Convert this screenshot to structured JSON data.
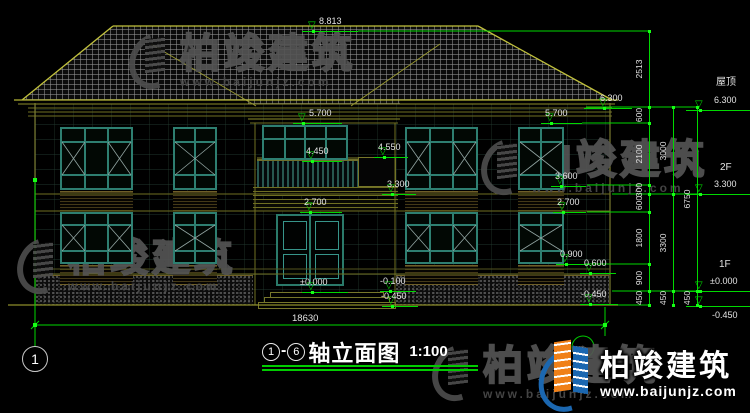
{
  "title": {
    "axis_from": "1",
    "dash": "-",
    "axis_to": "6",
    "text": "轴立面图",
    "scale": "1:100"
  },
  "axis": {
    "left_bubble": "1"
  },
  "dims": {
    "total_width": "18630"
  },
  "watermark": {
    "brand": "柏竣建筑",
    "url": "www.baijunjz.com"
  },
  "logo": {
    "brand": "柏竣建筑",
    "url": "www.baijunjz.com"
  },
  "colors": {
    "dim_green": "#00d800",
    "line_yellow": "#b5b535",
    "window_teal": "#2e7f71",
    "logo_blue": "#1b67b0",
    "logo_orange": "#f08018"
  },
  "level_markers": [
    {
      "v": "8.813",
      "y": 31,
      "x1": 302,
      "x2": 358,
      "tri": 313,
      "lx": 319,
      "ly": 16
    },
    {
      "v": "6.300",
      "y": 108,
      "x1": 584,
      "x2": 632,
      "tri": 604,
      "lx": 600,
      "ly": 93
    },
    {
      "v": "5.700",
      "y": 123,
      "x1": 293,
      "x2": 342,
      "tri": 303,
      "lx": 309,
      "ly": 108
    },
    {
      "v": "5.700",
      "y": 123,
      "x1": 541,
      "x2": 582,
      "tri": 551,
      "lx": 545,
      "ly": 108
    },
    {
      "v": "4.550",
      "y": 157,
      "x1": 374,
      "x2": 408,
      "tri": 384,
      "lx": 378,
      "ly": 142
    },
    {
      "v": "4.450",
      "y": 161,
      "x1": 302,
      "x2": 342,
      "tri": 312,
      "lx": 306,
      "ly": 146
    },
    {
      "v": "3.300",
      "y": 194,
      "x1": 382,
      "x2": 416,
      "tri": 392,
      "lx": 387,
      "ly": 179
    },
    {
      "v": "3.600",
      "y": 186,
      "x1": 551,
      "x2": 586,
      "tri": 561,
      "lx": 555,
      "ly": 171
    },
    {
      "v": "2.700",
      "y": 212,
      "x1": 300,
      "x2": 342,
      "tri": 310,
      "lx": 304,
      "ly": 197
    },
    {
      "v": "2.700",
      "y": 212,
      "x1": 553,
      "x2": 586,
      "tri": 563,
      "lx": 557,
      "ly": 197
    },
    {
      "v": "0.900",
      "y": 264,
      "x1": 556,
      "x2": 590,
      "tri": 566,
      "lx": 560,
      "ly": 249
    },
    {
      "v": "0.600",
      "y": 273,
      "x1": 580,
      "x2": 616,
      "tri": 590,
      "lx": 584,
      "ly": 258
    },
    {
      "v": "-0.450",
      "y": 304,
      "x1": 580,
      "x2": 618,
      "tri": 590,
      "lx": 581,
      "ly": 289
    },
    {
      "v": "±0.000",
      "y": 292,
      "x1": 302,
      "x2": 348,
      "tri": 312,
      "lx": 300,
      "ly": 277
    },
    {
      "v": "-0.100",
      "y": 291,
      "x1": 380,
      "x2": 416,
      "tri": 390,
      "lx": 380,
      "ly": 276
    },
    {
      "v": "-0.450",
      "y": 306,
      "x1": 382,
      "x2": 418,
      "tri": 392,
      "lx": 381,
      "ly": 291
    },
    {
      "v": "6.300",
      "name": "屋顶",
      "y": 110,
      "x1": 686,
      "x2": 750,
      "tri": 700,
      "lx": 714,
      "ly": 95,
      "nx": 716,
      "ny": 78
    },
    {
      "v": "3.300",
      "name": "2F",
      "y": 194,
      "x1": 686,
      "x2": 750,
      "tri": 700,
      "lx": 714,
      "ly": 179,
      "nx": 720,
      "ny": 163
    },
    {
      "v": "±0.000",
      "name": "1F",
      "y": 291,
      "x1": 686,
      "x2": 750,
      "tri": 700,
      "lx": 710,
      "ly": 276,
      "nx": 719,
      "ny": 260
    },
    {
      "v": "-0.450",
      "y": 306,
      "x1": 686,
      "x2": 750,
      "tri": 700,
      "lx": 712,
      "ly": 310,
      "below": true
    }
  ],
  "dim_chains": [
    {
      "x": 649,
      "segs": [
        {
          "v": "2513",
          "y1": 31,
          "y2": 107
        },
        {
          "v": "600",
          "y1": 107,
          "y2": 123
        },
        {
          "v": "2100",
          "y1": 123,
          "y2": 185
        },
        {
          "v": "300",
          "y1": 185,
          "y2": 194
        },
        {
          "v": "600",
          "y1": 194,
          "y2": 212
        },
        {
          "v": "1800",
          "y1": 212,
          "y2": 264
        },
        {
          "v": "900",
          "y1": 264,
          "y2": 291
        },
        {
          "v": "450",
          "y1": 291,
          "y2": 305
        }
      ]
    },
    {
      "x": 673,
      "segs": [
        {
          "v": "3000",
          "y1": 107,
          "y2": 194
        },
        {
          "v": "3300",
          "y1": 194,
          "y2": 291
        },
        {
          "v": "450",
          "y1": 291,
          "y2": 305
        }
      ]
    },
    {
      "x": 697,
      "segs": [
        {
          "v": "6750",
          "y1": 107,
          "y2": 291
        },
        {
          "v": "450",
          "y1": 291,
          "y2": 305
        }
      ]
    }
  ],
  "windows": [
    {
      "name": "window-2f-left-large",
      "x": 60,
      "y": 127,
      "w": 73,
      "h": 63,
      "cols": 3,
      "rows": [
        0.22,
        0.78
      ],
      "xc": "sides"
    },
    {
      "name": "window-2f-left-small",
      "x": 173,
      "y": 127,
      "w": 44,
      "h": 63,
      "cols": 2,
      "rows": [
        0.22,
        0.78
      ],
      "xc": "full"
    },
    {
      "name": "window-2f-right-large",
      "x": 405,
      "y": 127,
      "w": 73,
      "h": 63,
      "cols": 3,
      "rows": [
        0.22,
        0.78
      ],
      "xc": "sides"
    },
    {
      "name": "window-2f-right-small",
      "x": 518,
      "y": 127,
      "w": 46,
      "h": 63,
      "cols": 2,
      "rows": [
        0.22,
        0.78
      ],
      "xc": "full"
    },
    {
      "name": "window-1f-left-large",
      "x": 60,
      "y": 212,
      "w": 73,
      "h": 52,
      "cols": 3,
      "rows": [
        0.22,
        0.78
      ],
      "xc": "sides"
    },
    {
      "name": "window-1f-left-small",
      "x": 173,
      "y": 212,
      "w": 44,
      "h": 52,
      "cols": 2,
      "rows": [
        0.22,
        0.78
      ],
      "xc": "full"
    },
    {
      "name": "window-1f-right-large",
      "x": 405,
      "y": 212,
      "w": 73,
      "h": 52,
      "cols": 3,
      "rows": [
        0.22,
        0.78
      ],
      "xc": "sides"
    },
    {
      "name": "window-1f-right-small",
      "x": 518,
      "y": 212,
      "w": 46,
      "h": 52,
      "cols": 2,
      "rows": [
        0.22,
        0.78
      ],
      "xc": "full"
    },
    {
      "name": "window-2f-balcony",
      "x": 262,
      "y": 125,
      "w": 86,
      "h": 35,
      "cols": 4,
      "rows": [
        0.4
      ],
      "xc": "none"
    }
  ]
}
